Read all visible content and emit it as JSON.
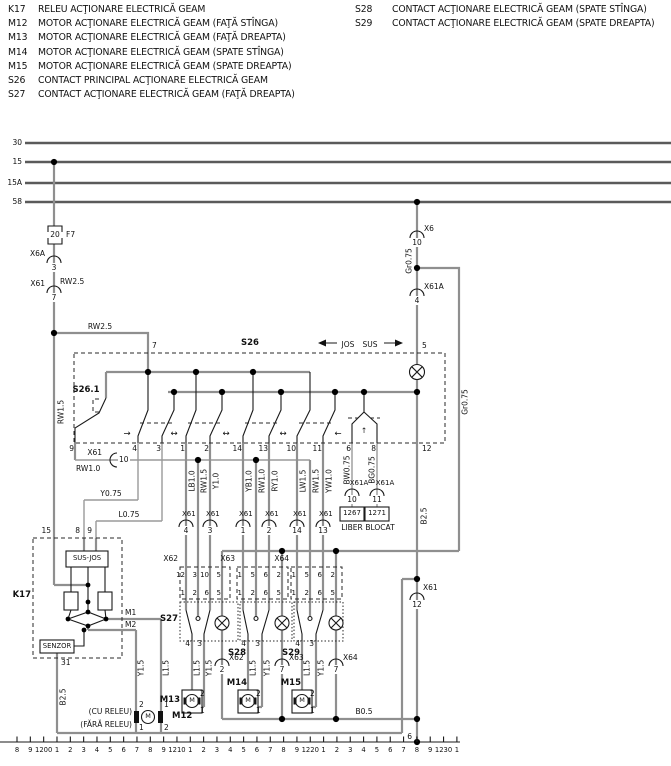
{
  "legend_left": [
    {
      "id": "K17",
      "desc": "RELEU ACŢIONARE ELECTRICĂ GEAM"
    },
    {
      "id": "M12",
      "desc": "MOTOR ACŢIONARE ELECTRICĂ GEAM (FAŢĂ STÎNGA)"
    },
    {
      "id": "M13",
      "desc": "MOTOR ACŢIONARE ELECTRICĂ GEAM (FAŢĂ DREAPTA)"
    },
    {
      "id": "M14",
      "desc": "MOTOR ACŢIONARE ELECTRICĂ GEAM (SPATE STÎNGA)"
    },
    {
      "id": "M15",
      "desc": "MOTOR ACŢIONARE ELECTRICĂ GEAM (SPATE DREAPTA)"
    },
    {
      "id": "S26",
      "desc": "CONTACT PRINCIPAL ACŢIONARE ELECTRICĂ GEAM"
    },
    {
      "id": "S27",
      "desc": "CONTACT ACŢIONARE ELECTRICĂ GEAM (FAŢĂ DREAPTA)"
    }
  ],
  "legend_right": [
    {
      "id": "S28",
      "desc": "CONTACT ACŢIONARE ELECTRICĂ GEAM (SPATE STÎNGA)"
    },
    {
      "id": "S29",
      "desc": "CONTACT ACŢIONARE ELECTRICĂ GEAM (SPATE DREAPTA)"
    }
  ],
  "ruler_ticks": [
    "8",
    "9",
    "1200",
    "1",
    "2",
    "3",
    "4",
    "5",
    "6",
    "7",
    "8",
    "9",
    "1210",
    "1",
    "2",
    "3",
    "4",
    "5",
    "6",
    "7",
    "8",
    "9",
    "1220",
    "1",
    "2",
    "3",
    "4",
    "5",
    "6",
    "7",
    "8",
    "9",
    "1230",
    "1"
  ],
  "colors": {
    "wire_gray": "#8f8f8f",
    "line_black": "#1a1a1a"
  },
  "labels": [
    {
      "n": "bus-30-label",
      "t": "30",
      "x": 22,
      "y": 146,
      "a": "e"
    },
    {
      "n": "bus-15-label",
      "t": "15",
      "x": 22,
      "y": 165,
      "a": "e"
    },
    {
      "n": "bus-15a-label",
      "t": "15A",
      "x": 22,
      "y": 186,
      "a": "e"
    },
    {
      "n": "bus-58-label",
      "t": "58",
      "x": 22,
      "y": 205,
      "a": "e"
    },
    {
      "n": "fuse-rating-label",
      "t": "20",
      "x": 55,
      "y": 238,
      "a": "m",
      "w": 1
    },
    {
      "n": "fuse-f7-label",
      "t": "F7",
      "x": 66,
      "y": 238,
      "a": "s"
    },
    {
      "n": "connector-label",
      "t": "X6A",
      "x": 45,
      "y": 257,
      "a": "e"
    },
    {
      "n": "connector-pin",
      "t": "3",
      "x": 54,
      "y": 271,
      "a": "m",
      "w": 1
    },
    {
      "n": "connector-label",
      "t": "X61",
      "x": 45,
      "y": 287,
      "a": "e"
    },
    {
      "n": "connector-pin",
      "t": "7",
      "x": 54,
      "y": 301,
      "a": "m",
      "w": 1
    },
    {
      "n": "wire-code-label",
      "t": "RW2.5",
      "x": 60,
      "y": 285,
      "a": "s"
    },
    {
      "n": "wire-code-label",
      "t": "RW2.5",
      "x": 100,
      "y": 330,
      "a": "m"
    },
    {
      "n": "connector-label",
      "t": "X6",
      "x": 424,
      "y": 232,
      "a": "s"
    },
    {
      "n": "connector-pin",
      "t": "10",
      "x": 417,
      "y": 246,
      "a": "m",
      "w": 1
    },
    {
      "n": "wire-code-label",
      "t": "Gr0.75",
      "x": 409,
      "y": 261,
      "r": 1
    },
    {
      "n": "connector-label",
      "t": "X61A",
      "x": 424,
      "y": 290,
      "a": "s"
    },
    {
      "n": "connector-pin",
      "t": "4",
      "x": 417,
      "y": 304,
      "a": "m",
      "w": 1
    },
    {
      "n": "wire-code-label",
      "t": "Gr0.75",
      "x": 465,
      "y": 402,
      "r": 1
    },
    {
      "n": "wire-code-label",
      "t": "RW1.5",
      "x": 61,
      "y": 412,
      "r": 1
    },
    {
      "n": "pin-label",
      "t": "7",
      "x": 152,
      "y": 349,
      "a": "s"
    },
    {
      "n": "component-label",
      "t": "S26",
      "x": 250,
      "y": 347,
      "a": "m",
      "b": 1
    },
    {
      "n": "direction-label",
      "t": "JOS",
      "x": 348,
      "y": 348,
      "a": "m"
    },
    {
      "n": "direction-label",
      "t": "SUS",
      "x": 370,
      "y": 348,
      "a": "m"
    },
    {
      "n": "pin-label",
      "t": "5",
      "x": 422,
      "y": 349,
      "a": "s"
    },
    {
      "n": "component-label",
      "t": "S26.1",
      "x": 86,
      "y": 394,
      "a": "m",
      "b": 1
    },
    {
      "n": "pin-label",
      "t": "9",
      "x": 74,
      "y": 452,
      "a": "e"
    },
    {
      "n": "pin-label",
      "t": "4",
      "x": 137,
      "y": 452,
      "a": "e"
    },
    {
      "n": "pin-label",
      "t": "3",
      "x": 161,
      "y": 452,
      "a": "e"
    },
    {
      "n": "pin-label",
      "t": "1",
      "x": 185,
      "y": 452,
      "a": "e"
    },
    {
      "n": "pin-label",
      "t": "2",
      "x": 209,
      "y": 452,
      "a": "e"
    },
    {
      "n": "pin-label",
      "t": "14",
      "x": 242,
      "y": 452,
      "a": "e"
    },
    {
      "n": "pin-label",
      "t": "13",
      "x": 268,
      "y": 452,
      "a": "e"
    },
    {
      "n": "pin-label",
      "t": "10",
      "x": 296,
      "y": 452,
      "a": "e"
    },
    {
      "n": "pin-label",
      "t": "11",
      "x": 322,
      "y": 452,
      "a": "e"
    },
    {
      "n": "pin-label",
      "t": "6",
      "x": 351,
      "y": 452,
      "a": "e"
    },
    {
      "n": "pin-label",
      "t": "8",
      "x": 376,
      "y": 452,
      "a": "e"
    },
    {
      "n": "pin-label",
      "t": "12",
      "x": 422,
      "y": 452,
      "a": "s"
    },
    {
      "n": "connector-label",
      "t": "X61",
      "x": 102,
      "y": 456,
      "a": "e"
    },
    {
      "n": "connector-pin",
      "t": "10",
      "x": 118,
      "y": 463,
      "a": "s",
      "w": 1
    },
    {
      "n": "wire-code-label",
      "t": "RW1.0",
      "x": 76,
      "y": 472,
      "a": "s"
    },
    {
      "n": "wire-code-label",
      "t": "Y0.75",
      "x": 111,
      "y": 497,
      "a": "m"
    },
    {
      "n": "wire-code-label",
      "t": "L0.75",
      "x": 129,
      "y": 518,
      "a": "m"
    },
    {
      "n": "wire-code-label",
      "t": "LB1.0",
      "x": 192,
      "y": 481,
      "r": 1
    },
    {
      "n": "wire-code-label",
      "t": "RW1.5",
      "x": 204,
      "y": 481,
      "r": 1
    },
    {
      "n": "wire-code-label",
      "t": "Y1.0",
      "x": 216,
      "y": 481,
      "r": 1
    },
    {
      "n": "wire-code-label",
      "t": "YB1.0",
      "x": 249,
      "y": 481,
      "r": 1
    },
    {
      "n": "wire-code-label",
      "t": "RW1.0",
      "x": 262,
      "y": 481,
      "r": 1
    },
    {
      "n": "wire-code-label",
      "t": "RY1.0",
      "x": 275,
      "y": 481,
      "r": 1
    },
    {
      "n": "wire-code-label",
      "t": "LW1.5",
      "x": 303,
      "y": 481,
      "r": 1
    },
    {
      "n": "wire-code-label",
      "t": "RW1.5",
      "x": 316,
      "y": 481,
      "r": 1
    },
    {
      "n": "wire-code-label",
      "t": "YW1.0",
      "x": 329,
      "y": 481,
      "r": 1
    },
    {
      "n": "wire-code-label",
      "t": "BW0.75",
      "x": 347,
      "y": 470,
      "r": 1
    },
    {
      "n": "wire-code-label",
      "t": "BG0.75",
      "x": 372,
      "y": 470,
      "r": 1
    },
    {
      "n": "connector-label",
      "t": "X61A",
      "x": 359,
      "y": 487,
      "a": "m",
      "s": 7
    },
    {
      "n": "connector-label",
      "t": "X61A",
      "x": 385,
      "y": 487,
      "a": "m",
      "s": 7
    },
    {
      "n": "connector-pin",
      "t": "10",
      "x": 352,
      "y": 503,
      "a": "m",
      "w": 1
    },
    {
      "n": "connector-pin",
      "t": "11",
      "x": 377,
      "y": 503,
      "a": "m",
      "w": 1
    },
    {
      "n": "reference-number",
      "t": "1267",
      "x": 352,
      "y": 517,
      "a": "m",
      "s": 7
    },
    {
      "n": "reference-number",
      "t": "1271",
      "x": 377,
      "y": 517,
      "a": "m",
      "s": 7
    },
    {
      "n": "state-label",
      "t": "LIBER",
      "x": 352,
      "y": 531,
      "a": "m"
    },
    {
      "n": "state-label",
      "t": "BLOCAT",
      "x": 380,
      "y": 531,
      "a": "m"
    },
    {
      "n": "connector-label",
      "t": "X61",
      "x": 182,
      "y": 518,
      "a": "s",
      "s": 7
    },
    {
      "n": "connector-label",
      "t": "X61",
      "x": 206,
      "y": 518,
      "a": "s",
      "s": 7
    },
    {
      "n": "connector-label",
      "t": "X61",
      "x": 239,
      "y": 518,
      "a": "s",
      "s": 7
    },
    {
      "n": "connector-label",
      "t": "X61",
      "x": 265,
      "y": 518,
      "a": "s",
      "s": 7
    },
    {
      "n": "connector-label",
      "t": "X61",
      "x": 293,
      "y": 518,
      "a": "s",
      "s": 7
    },
    {
      "n": "connector-label",
      "t": "X61",
      "x": 319,
      "y": 518,
      "a": "s",
      "s": 7
    },
    {
      "n": "connector-pin",
      "t": "4",
      "x": 186,
      "y": 534,
      "a": "m",
      "w": 1
    },
    {
      "n": "connector-pin",
      "t": "3",
      "x": 210,
      "y": 534,
      "a": "m",
      "w": 1
    },
    {
      "n": "connector-pin",
      "t": "1",
      "x": 243,
      "y": 534,
      "a": "m",
      "w": 1
    },
    {
      "n": "connector-pin",
      "t": "2",
      "x": 269,
      "y": 534,
      "a": "m",
      "w": 1
    },
    {
      "n": "connector-pin",
      "t": "14",
      "x": 297,
      "y": 534,
      "a": "m",
      "w": 1
    },
    {
      "n": "connector-pin",
      "t": "13",
      "x": 323,
      "y": 534,
      "a": "m",
      "w": 1
    },
    {
      "n": "connector-label",
      "t": "X62",
      "x": 178,
      "y": 562,
      "a": "e"
    },
    {
      "n": "connector-label",
      "t": "X63",
      "x": 235,
      "y": 562,
      "a": "e"
    },
    {
      "n": "connector-label",
      "t": "X64",
      "x": 289,
      "y": 562,
      "a": "e"
    },
    {
      "n": "connector-pin",
      "t": "12",
      "x": 185,
      "y": 579,
      "a": "e",
      "s": 7
    },
    {
      "n": "connector-pin",
      "t": "3",
      "x": 197,
      "y": 579,
      "a": "e",
      "s": 7
    },
    {
      "n": "connector-pin",
      "t": "10",
      "x": 209,
      "y": 579,
      "a": "e",
      "s": 7
    },
    {
      "n": "connector-pin",
      "t": "5",
      "x": 221,
      "y": 579,
      "a": "e",
      "s": 7
    },
    {
      "n": "connector-pin",
      "t": "1",
      "x": 185,
      "y": 597,
      "a": "e",
      "s": 7
    },
    {
      "n": "connector-pin",
      "t": "2",
      "x": 197,
      "y": 597,
      "a": "e",
      "s": 7
    },
    {
      "n": "connector-pin",
      "t": "6",
      "x": 209,
      "y": 597,
      "a": "e",
      "s": 7
    },
    {
      "n": "connector-pin",
      "t": "5",
      "x": 221,
      "y": 597,
      "a": "e",
      "s": 7
    },
    {
      "n": "connector-pin",
      "t": "1",
      "x": 242,
      "y": 579,
      "a": "e",
      "s": 7
    },
    {
      "n": "connector-pin",
      "t": "5",
      "x": 255,
      "y": 579,
      "a": "e",
      "s": 7
    },
    {
      "n": "connector-pin",
      "t": "6",
      "x": 268,
      "y": 579,
      "a": "e",
      "s": 7
    },
    {
      "n": "connector-pin",
      "t": "2",
      "x": 281,
      "y": 579,
      "a": "e",
      "s": 7
    },
    {
      "n": "connector-pin",
      "t": "1",
      "x": 242,
      "y": 597,
      "a": "e",
      "s": 7
    },
    {
      "n": "connector-pin",
      "t": "2",
      "x": 255,
      "y": 597,
      "a": "e",
      "s": 7
    },
    {
      "n": "connector-pin",
      "t": "6",
      "x": 268,
      "y": 597,
      "a": "e",
      "s": 7
    },
    {
      "n": "connector-pin",
      "t": "5",
      "x": 281,
      "y": 597,
      "a": "e",
      "s": 7
    },
    {
      "n": "connector-pin",
      "t": "1",
      "x": 296,
      "y": 579,
      "a": "e",
      "s": 7
    },
    {
      "n": "connector-pin",
      "t": "5",
      "x": 309,
      "y": 579,
      "a": "e",
      "s": 7
    },
    {
      "n": "connector-pin",
      "t": "6",
      "x": 322,
      "y": 579,
      "a": "e",
      "s": 7
    },
    {
      "n": "connector-pin",
      "t": "2",
      "x": 335,
      "y": 579,
      "a": "e",
      "s": 7
    },
    {
      "n": "connector-pin",
      "t": "1",
      "x": 296,
      "y": 597,
      "a": "e",
      "s": 7
    },
    {
      "n": "connector-pin",
      "t": "2",
      "x": 309,
      "y": 597,
      "a": "e",
      "s": 7
    },
    {
      "n": "connector-pin",
      "t": "6",
      "x": 322,
      "y": 597,
      "a": "e",
      "s": 7
    },
    {
      "n": "connector-pin",
      "t": "5",
      "x": 335,
      "y": 597,
      "a": "e",
      "s": 7
    },
    {
      "n": "component-label",
      "t": "S27",
      "x": 178,
      "y": 623,
      "a": "e",
      "b": 1
    },
    {
      "n": "component-label",
      "t": "S28",
      "x": 246,
      "y": 657,
      "a": "e",
      "b": 1
    },
    {
      "n": "component-label",
      "t": "S29",
      "x": 300,
      "y": 657,
      "a": "e",
      "b": 1
    },
    {
      "n": "pin-label",
      "t": "4",
      "x": 190,
      "y": 647,
      "a": "e"
    },
    {
      "n": "pin-label",
      "t": "3",
      "x": 202,
      "y": 647,
      "a": "e"
    },
    {
      "n": "pin-label",
      "t": "4",
      "x": 246,
      "y": 647,
      "a": "e"
    },
    {
      "n": "pin-label",
      "t": "3",
      "x": 260,
      "y": 647,
      "a": "e"
    },
    {
      "n": "pin-label",
      "t": "4",
      "x": 300,
      "y": 647,
      "a": "e"
    },
    {
      "n": "pin-label",
      "t": "3",
      "x": 314,
      "y": 647,
      "a": "e"
    },
    {
      "n": "wire-code-label",
      "t": "Y1.5",
      "x": 141,
      "y": 668,
      "r": 1
    },
    {
      "n": "wire-code-label",
      "t": "L1.5",
      "x": 166,
      "y": 668,
      "r": 1
    },
    {
      "n": "wire-code-label",
      "t": "L1.5",
      "x": 197,
      "y": 668,
      "r": 1
    },
    {
      "n": "wire-code-label",
      "t": "Y1.5",
      "x": 209,
      "y": 668,
      "r": 1
    },
    {
      "n": "wire-code-label",
      "t": "L1.5",
      "x": 253,
      "y": 668,
      "r": 1
    },
    {
      "n": "wire-code-label",
      "t": "Y1.5",
      "x": 267,
      "y": 668,
      "r": 1
    },
    {
      "n": "wire-code-label",
      "t": "L1.5",
      "x": 307,
      "y": 668,
      "r": 1
    },
    {
      "n": "wire-code-label",
      "t": "Y1.5",
      "x": 321,
      "y": 668,
      "r": 1
    },
    {
      "n": "connector-label",
      "t": "X62",
      "x": 229,
      "y": 661,
      "a": "s"
    },
    {
      "n": "connector-pin",
      "t": "2",
      "x": 222,
      "y": 673,
      "a": "m",
      "w": 1
    },
    {
      "n": "connector-label",
      "t": "X63",
      "x": 289,
      "y": 661,
      "a": "s"
    },
    {
      "n": "connector-pin",
      "t": "7",
      "x": 282,
      "y": 673,
      "a": "m",
      "w": 1
    },
    {
      "n": "connector-label",
      "t": "X64",
      "x": 343,
      "y": 661,
      "a": "s"
    },
    {
      "n": "connector-pin",
      "t": "7",
      "x": 336,
      "y": 673,
      "a": "m",
      "w": 1
    },
    {
      "n": "component-label",
      "t": "M13",
      "x": 180,
      "y": 704,
      "a": "e",
      "b": 1
    },
    {
      "n": "component-label",
      "t": "M14",
      "x": 247,
      "y": 687,
      "a": "e",
      "b": 1
    },
    {
      "n": "component-label",
      "t": "M15",
      "x": 301,
      "y": 687,
      "a": "e",
      "b": 1
    },
    {
      "n": "component-label",
      "t": "M12",
      "x": 172,
      "y": 720,
      "a": "s",
      "b": 1
    },
    {
      "n": "motor-letter",
      "t": "M",
      "x": 192,
      "y": 704,
      "a": "m",
      "s": 6.5
    },
    {
      "n": "motor-letter",
      "t": "M",
      "x": 248,
      "y": 704,
      "a": "m",
      "s": 6.5
    },
    {
      "n": "motor-letter",
      "t": "M",
      "x": 302,
      "y": 704,
      "a": "m",
      "s": 6.5
    },
    {
      "n": "motor-letter",
      "t": "M",
      "x": 148,
      "y": 720,
      "a": "m",
      "s": 6.5
    },
    {
      "n": "pin-label",
      "t": "2",
      "x": 200,
      "y": 697,
      "a": "s"
    },
    {
      "n": "pin-label",
      "t": "1",
      "x": 200,
      "y": 714,
      "a": "s"
    },
    {
      "n": "pin-label",
      "t": "2",
      "x": 256,
      "y": 697,
      "a": "s"
    },
    {
      "n": "pin-label",
      "t": "1",
      "x": 256,
      "y": 714,
      "a": "s"
    },
    {
      "n": "pin-label",
      "t": "2",
      "x": 310,
      "y": 697,
      "a": "s"
    },
    {
      "n": "pin-label",
      "t": "1",
      "x": 310,
      "y": 714,
      "a": "s"
    },
    {
      "n": "option-label",
      "t": "(CU RELEU)",
      "x": 132,
      "y": 715,
      "a": "e"
    },
    {
      "n": "option-label",
      "t": "(FĂRĂ RELEU)",
      "x": 132,
      "y": 728,
      "a": "e"
    },
    {
      "n": "pin-label",
      "t": "2",
      "x": 139,
      "y": 708,
      "a": "s"
    },
    {
      "n": "pin-label",
      "t": "1",
      "x": 164,
      "y": 708,
      "a": "s"
    },
    {
      "n": "pin-label",
      "t": "1",
      "x": 139,
      "y": 731,
      "a": "s"
    },
    {
      "n": "pin-label",
      "t": "2",
      "x": 164,
      "y": 731,
      "a": "s"
    },
    {
      "n": "component-label",
      "t": "K17",
      "x": 31,
      "y": 599,
      "a": "e",
      "b": 1
    },
    {
      "n": "pin-label",
      "t": "15",
      "x": 51,
      "y": 534,
      "a": "e"
    },
    {
      "n": "pin-label",
      "t": "8",
      "x": 80,
      "y": 534,
      "a": "e"
    },
    {
      "n": "pin-label",
      "t": "9",
      "x": 92,
      "y": 534,
      "a": "e"
    },
    {
      "n": "relay-block-label",
      "t": "SUS-JOS",
      "x": 87,
      "y": 562,
      "a": "m",
      "s": 6.8
    },
    {
      "n": "relay-block-label",
      "t": "SENZOR",
      "x": 57,
      "y": 650,
      "a": "m",
      "s": 6.8
    },
    {
      "n": "terminal-label",
      "t": "M1",
      "x": 125,
      "y": 616,
      "a": "s"
    },
    {
      "n": "terminal-label",
      "t": "M2",
      "x": 125,
      "y": 628,
      "a": "s"
    },
    {
      "n": "pin-label",
      "t": "31",
      "x": 61,
      "y": 666,
      "a": "s"
    },
    {
      "n": "wire-code-label",
      "t": "B2.5",
      "x": 63,
      "y": 697,
      "r": 1
    },
    {
      "n": "wire-code-label",
      "t": "B2.5",
      "x": 424,
      "y": 516,
      "r": 1
    },
    {
      "n": "wire-code-label",
      "t": "B0.5",
      "x": 364,
      "y": 715,
      "a": "m"
    },
    {
      "n": "connector-label",
      "t": "X61",
      "x": 423,
      "y": 591,
      "a": "s"
    },
    {
      "n": "connector-pin",
      "t": "12",
      "x": 417,
      "y": 608,
      "a": "m",
      "w": 1
    },
    {
      "n": "pin-label",
      "t": "6",
      "x": 412,
      "y": 740,
      "a": "e"
    },
    {
      "n": "left-arrow-icon",
      "t": "→",
      "x": 127,
      "y": 438,
      "a": "m",
      "s": 8.5
    },
    {
      "n": "updown-arrow-icon",
      "t": "↔",
      "x": 174,
      "y": 438,
      "a": "m",
      "s": 8.5
    },
    {
      "n": "updown-arrow-icon",
      "t": "↔",
      "x": 226,
      "y": 438,
      "a": "m",
      "s": 8.5
    },
    {
      "n": "updown-arrow-icon",
      "t": "↔",
      "x": 283,
      "y": 438,
      "a": "m",
      "s": 8.5
    },
    {
      "n": "right-arrow-icon",
      "t": "←",
      "x": 338,
      "y": 438,
      "a": "m",
      "s": 8.5
    },
    {
      "n": "lock-arrow-icon",
      "t": "↑",
      "x": 364,
      "y": 434,
      "a": "m",
      "s": 7.5
    }
  ]
}
